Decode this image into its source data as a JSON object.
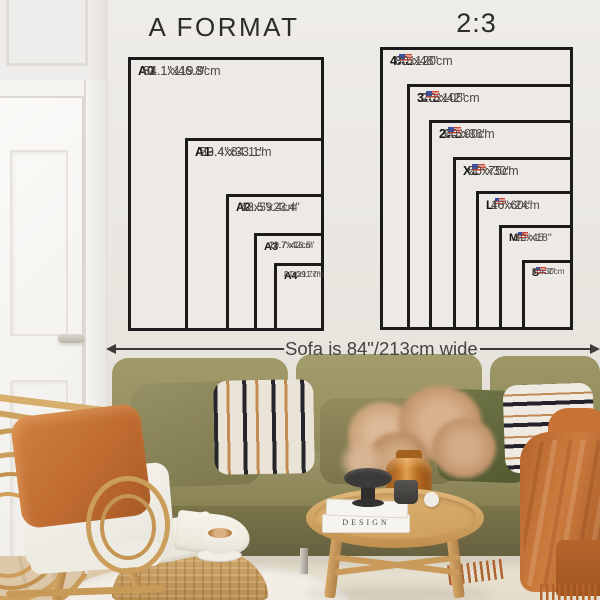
{
  "left_diagram": {
    "title": "A FORMAT",
    "sizes": [
      {
        "label": "A0",
        "inches": "31.1\"x46.8\"",
        "cm": "84.1x119.9cm"
      },
      {
        "label": "A1",
        "inches": "23.4\"x33.1\"",
        "cm": "59.4x84.1cm"
      },
      {
        "label": "A2",
        "inches": "16.5\"x23.4\"",
        "cm": "42x59.4cm"
      },
      {
        "label": "A3",
        "inches": "11.7\"x16.5\"",
        "cm": "29.7x42cm"
      },
      {
        "label": "A4",
        "inches": "8.3\"x11.7\"",
        "cm": "21x29.7cm"
      }
    ]
  },
  "right_diagram": {
    "title": "2:3",
    "sizes": [
      {
        "label": "4XL",
        "inches": "32\"x48\"",
        "cm": "80x120cm"
      },
      {
        "label": "3XL",
        "inches": "28\"x42\"",
        "cm": "70x105cm"
      },
      {
        "label": "2XL",
        "inches": "24\"x36\"",
        "cm": "60x90cm"
      },
      {
        "label": "XL",
        "inches": "20\"x30\"",
        "cm": "50x75cm"
      },
      {
        "label": "L",
        "inches": "16\"x24\"",
        "cm": "40x60cm"
      },
      {
        "label": "M",
        "inches": "12\"x18\"",
        "cm": "30x45"
      },
      {
        "label": "S",
        "inches": "8\"x12\"",
        "cm": "20x30cm"
      }
    ]
  },
  "sofa_note": {
    "text": "Sofa is 84\"/213cm wide"
  },
  "decor": {
    "book_spine": "DESIGN"
  },
  "colors": {
    "frame_black": "#1b1b1b",
    "wall": "#eae7e2",
    "sofa_olive": "#8c8657",
    "accent_rust": "#c06c31",
    "wood_oak": "#d2a567"
  }
}
